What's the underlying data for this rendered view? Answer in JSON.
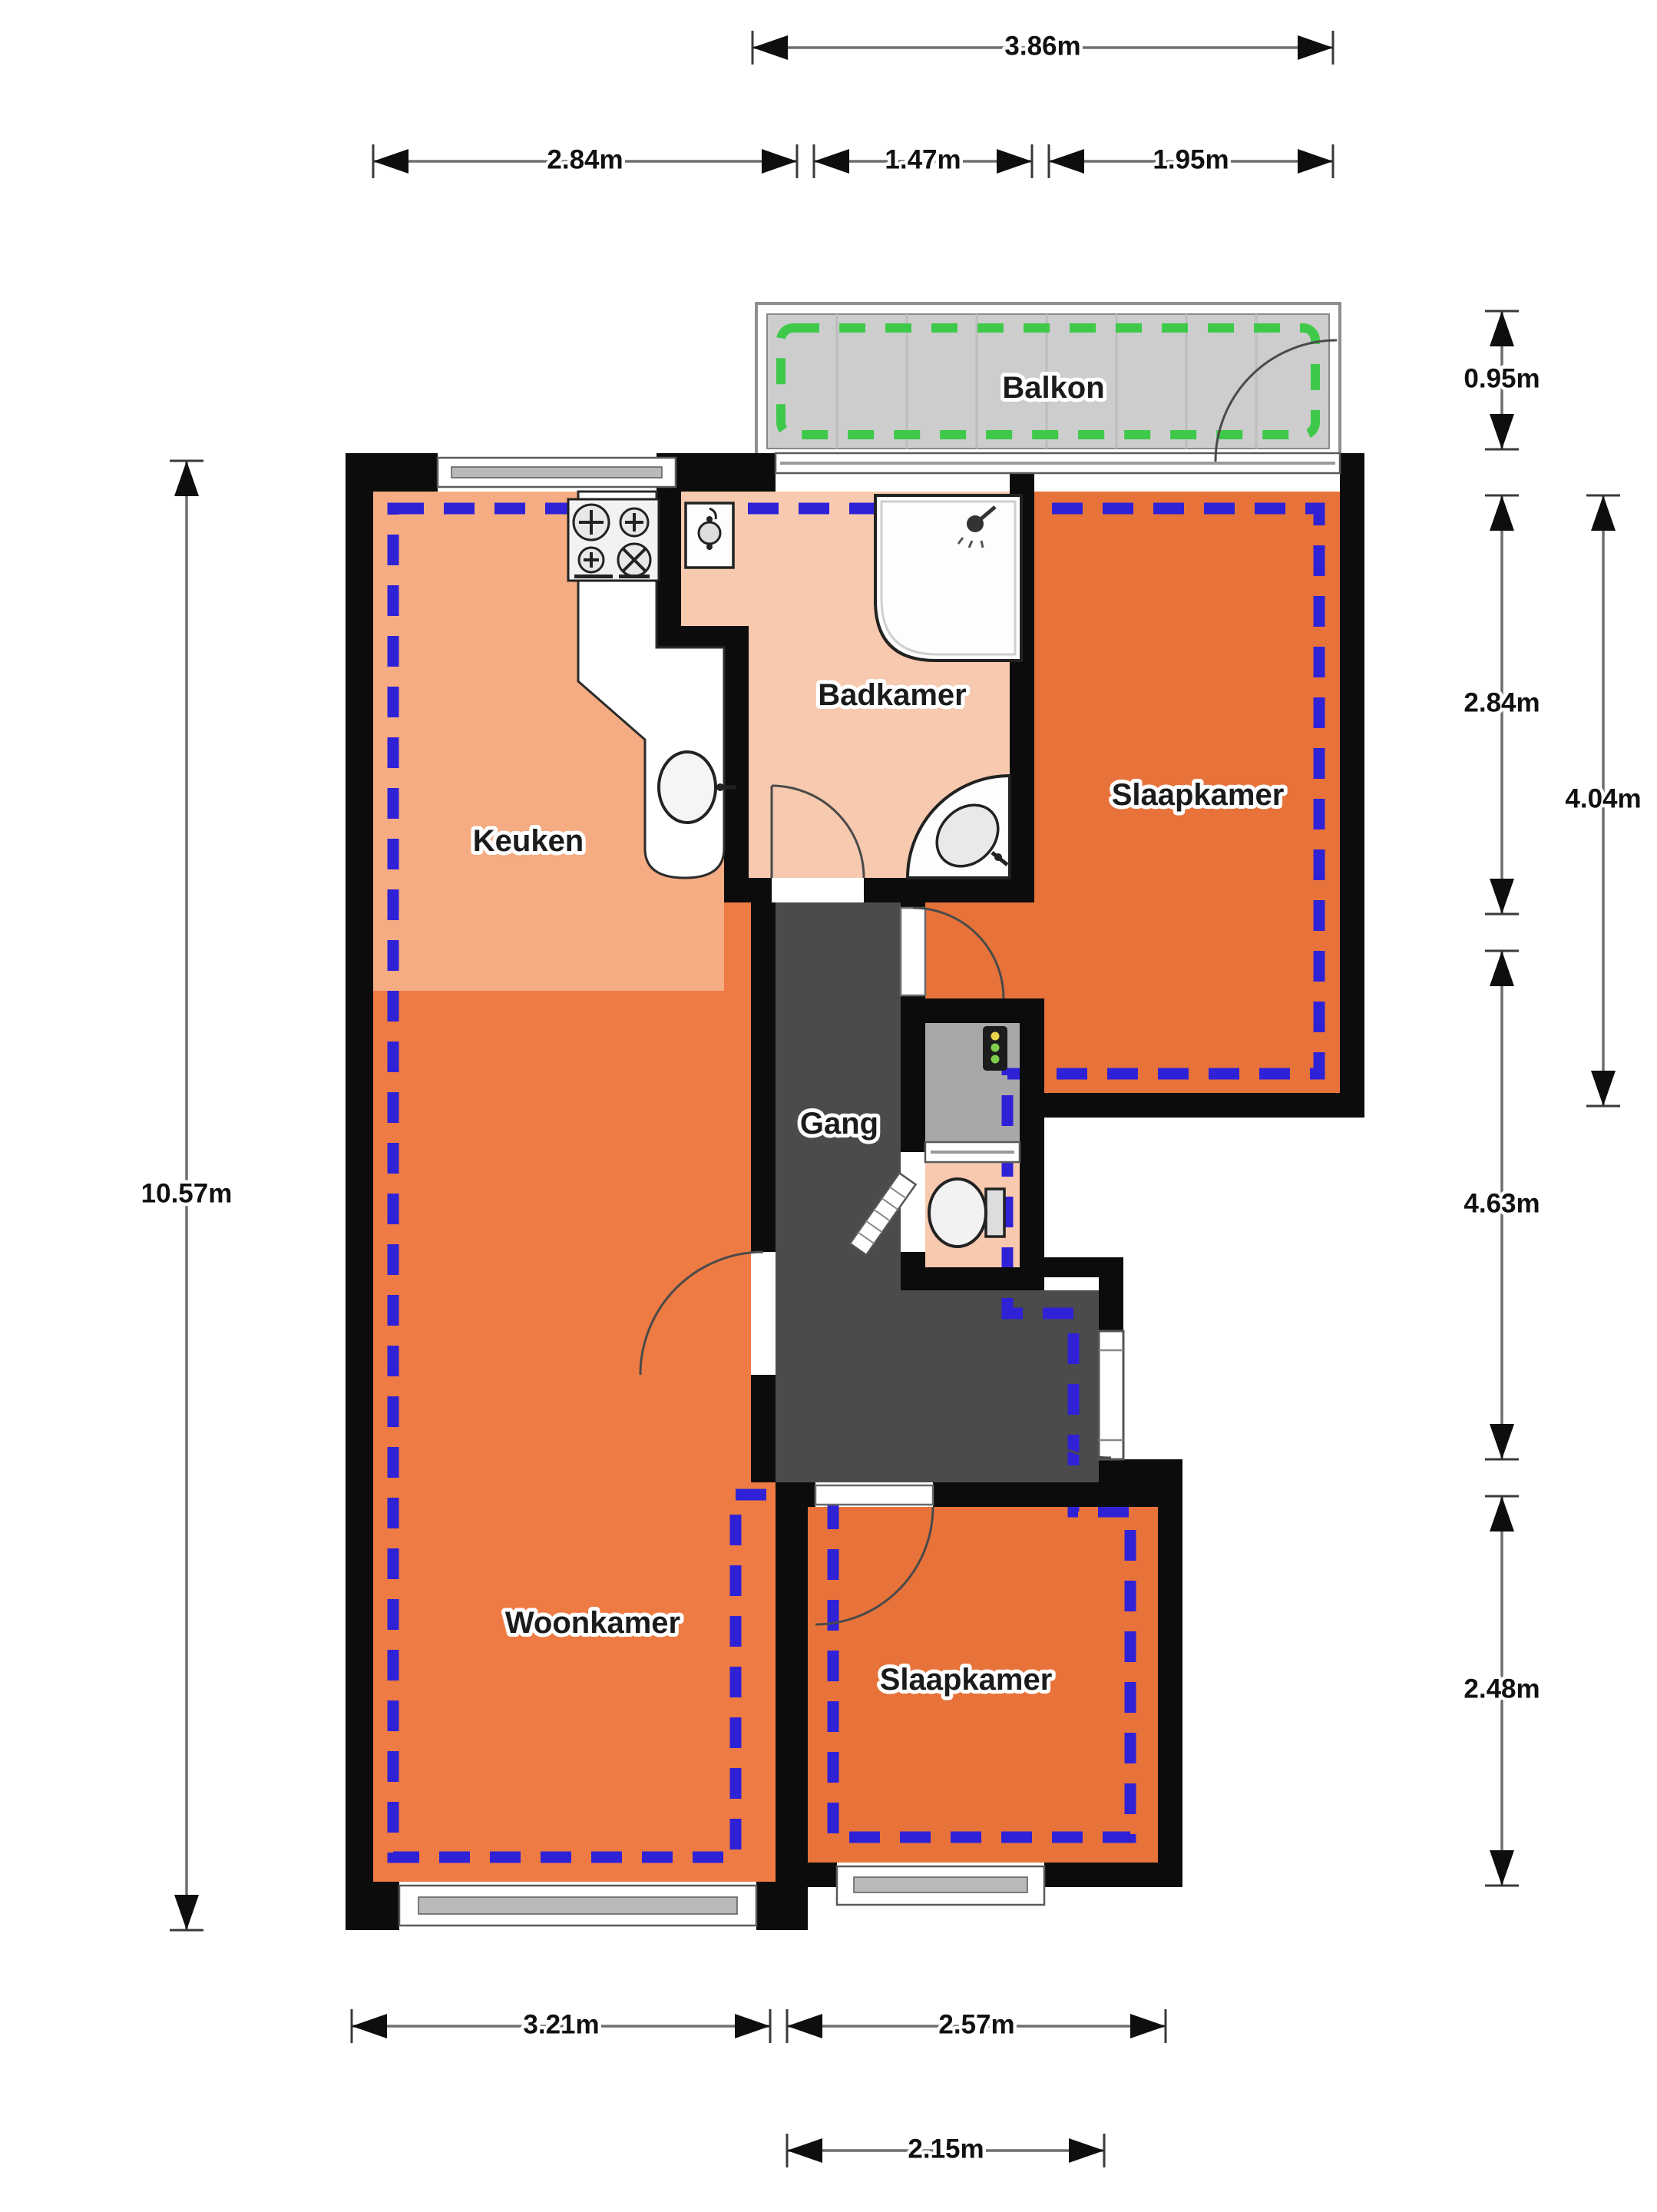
{
  "plan": {
    "kind": "apartment-floorplan",
    "rooms": {
      "balkon": "Balkon",
      "badkamer": "Badkamer",
      "slaapkamer_top": "Slaapkamer",
      "keuken": "Keuken",
      "gang": "Gang",
      "woonkamer": "Woonkamer",
      "slaapkamer_bottom": "Slaapkamer"
    },
    "dims": {
      "d386": "3.86m",
      "d284a": "2.84m",
      "d147": "1.47m",
      "d195": "1.95m",
      "d095": "0.95m",
      "d284b": "2.84m",
      "d404": "4.04m",
      "d463": "4.63m",
      "d248": "2.48m",
      "d1057": "10.57m",
      "d321": "3.21m",
      "d257": "2.57m",
      "d215": "2.15m"
    },
    "colors": {
      "wall": "#0c0c0c",
      "kitchen_floor": "#f5ac82",
      "living_floor": "#ee7b43",
      "bedroom_floor": "#e8733a",
      "bathroom_floor": "#f7c9ae",
      "hallway_floor": "#4b4b4b",
      "closet_floor": "#a8a8a8",
      "balcony_floor": "#cdcdcd",
      "insulation_dash_blue": "#2f22d6",
      "balcony_dash_green": "#3fc94b"
    }
  }
}
